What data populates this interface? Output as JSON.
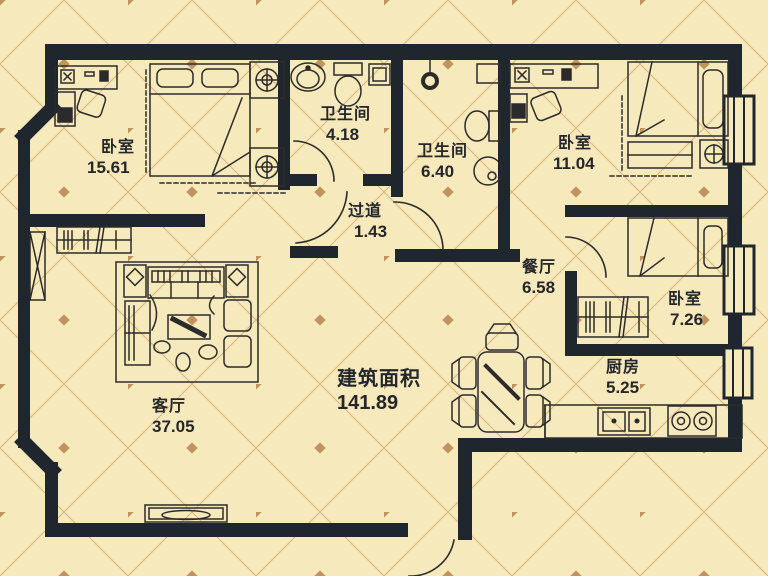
{
  "title": "apartment-floor-plan",
  "rooms": [
    {
      "id": "bedroom-master",
      "name": "卧室",
      "area": "15.61"
    },
    {
      "id": "bathroom-small",
      "name": "卫生间",
      "area": "4.18"
    },
    {
      "id": "bathroom-large",
      "name": "卫生间",
      "area": "6.40"
    },
    {
      "id": "hallway",
      "name": "过道",
      "area": "1.43"
    },
    {
      "id": "bedroom-right",
      "name": "卧室",
      "area": "11.04"
    },
    {
      "id": "dining-room",
      "name": "餐厅",
      "area": "6.58"
    },
    {
      "id": "bedroom-small",
      "name": "卧室",
      "area": "7.26"
    },
    {
      "id": "kitchen",
      "name": "厨房",
      "area": "5.25"
    },
    {
      "id": "living-room",
      "name": "客厅",
      "area": "37.05"
    }
  ],
  "total": {
    "label": "建筑面积",
    "value": "141.89"
  },
  "colors": {
    "background": "#f6e9bb",
    "wall": "#20262e",
    "lattice_line": "#caa468",
    "lattice_diamond": "#b9854d",
    "furniture_line": "#2b2b2b",
    "text": "#23272b"
  }
}
